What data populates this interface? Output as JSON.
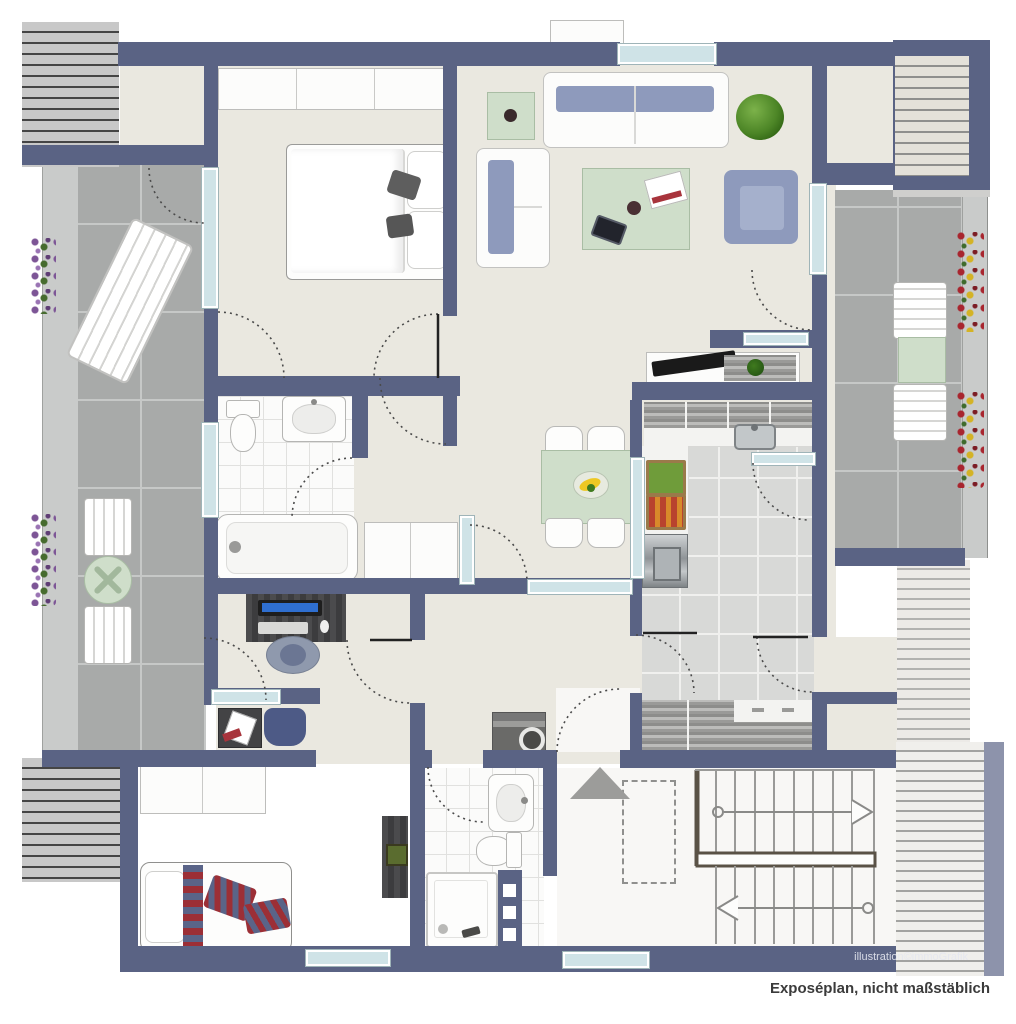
{
  "caption": {
    "text": "Exposéplan, nicht maßstäblich"
  },
  "watermark": {
    "text": "illustration©immoGrafik"
  },
  "colors": {
    "wall": "#5a6384",
    "floor_interior": "#eae8e0",
    "floor_entrance": "#f8f7f5",
    "terrace_tile": "#a8aaa9",
    "bath_tile": "#fbfbfa",
    "kitchen_tile": "#d8d9d7",
    "window_glass": "#cfe3e7",
    "sofa_blue": "#8e9abc",
    "glass_table_green": "#cfdeca",
    "textile_red": "#9c2f36",
    "plant_green": "#4c8526"
  },
  "rooms": [
    {
      "name": "terrace-left",
      "furniture": [
        "sun-lounger",
        "chair",
        "round-table",
        "chair",
        "flower-box",
        "flower-box"
      ]
    },
    {
      "name": "bedroom",
      "furniture": [
        "wardrobe",
        "double-bed"
      ]
    },
    {
      "name": "living-room",
      "furniture": [
        "side-table",
        "sofa",
        "loveseat",
        "coffee-table",
        "armchair",
        "plant",
        "tv-sideboard"
      ]
    },
    {
      "name": "dining-area",
      "furniture": [
        "dining-table",
        "chair",
        "chair",
        "chair",
        "chair",
        "fruit-bowl"
      ]
    },
    {
      "name": "kitchen",
      "furniture": [
        "wall-cabinets",
        "counter-with-sink",
        "vegetable-crate",
        "vegetable-crate",
        "stove",
        "base-cabinets"
      ]
    },
    {
      "name": "bathroom",
      "furniture": [
        "toilet",
        "washbasin",
        "bathtub",
        "closet"
      ]
    },
    {
      "name": "hallway",
      "furniture": [
        "desk",
        "monitor",
        "office-chair",
        "side-table",
        "chair",
        "washing-machine"
      ]
    },
    {
      "name": "bedroom-2",
      "furniture": [
        "wardrobe",
        "bed",
        "dresser"
      ]
    },
    {
      "name": "bathroom-2",
      "furniture": [
        "washbasin",
        "toilet",
        "shower",
        "shelf-niches"
      ]
    },
    {
      "name": "entrance",
      "furniture": [
        "entrance-arrow",
        "dashed-storage-area"
      ]
    },
    {
      "name": "stairwell",
      "furniture": [
        "stairs-up-arrow-right",
        "stairs-down-arrow-left"
      ]
    },
    {
      "name": "terrace-right",
      "furniture": [
        "chair",
        "table",
        "chair",
        "flower-box",
        "flower-box"
      ]
    }
  ]
}
